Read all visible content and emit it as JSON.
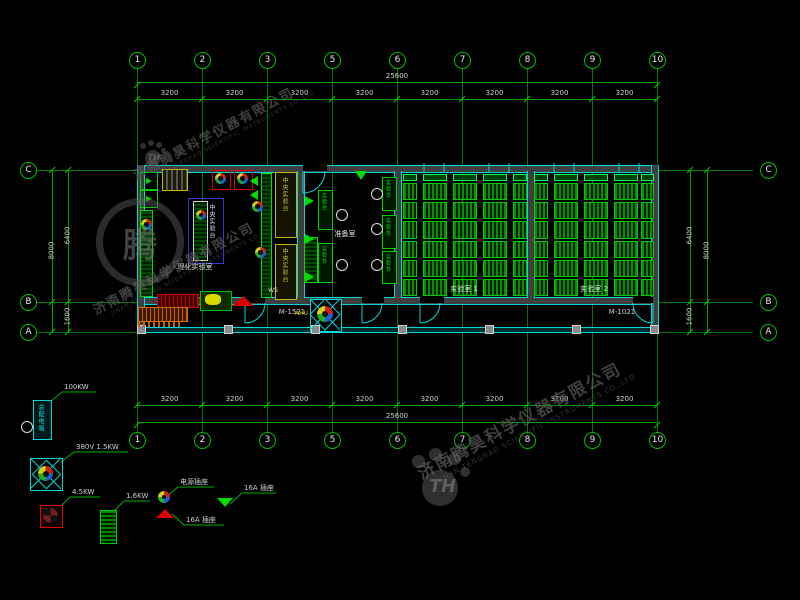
{
  "watermark": {
    "company_cn": "济南腾昊科学仪器有限公司",
    "company_en": "JINAN TENGHAO SCIENTIFIC INSTRUMENTS CO.,LTD",
    "logo_text": "TH",
    "logo_char": "腾"
  },
  "grid": {
    "column_labels": [
      "1",
      "2",
      "3",
      "5",
      "6",
      "7",
      "8",
      "9",
      "10"
    ],
    "row_labels": [
      "C",
      "B",
      "A"
    ],
    "bay_dims": [
      "3200",
      "3200",
      "3200",
      "3200",
      "3200",
      "3200",
      "3200",
      "3200"
    ],
    "total_dim": "25600",
    "left_dims": {
      "span_upper": "6400",
      "total": "8000",
      "span_lower": "1600"
    },
    "right_dims": {
      "span_upper": "6400",
      "total": "8000",
      "span_lower": "1600"
    }
  },
  "plan": {
    "door_left": "M-1521",
    "door_right": "M-1021",
    "room_left_label": "理化实验室",
    "room_middle_label": "准备室",
    "room1_label": "实验室 1",
    "room2_label": "实验室 2",
    "central_bench_label": "中央实验台",
    "side_bench_label": "实验台",
    "ahu_label": "AHU",
    "ws_label": "WS"
  },
  "legend": {
    "items": [
      {
        "id": "main-panel",
        "symbol": "distribution-box",
        "box_text": "总配电箱",
        "label": "100KW"
      },
      {
        "id": "fan-380v",
        "symbol": "axial-fan-cyan",
        "label": "380V 1.5KW"
      },
      {
        "id": "fan-45kw",
        "symbol": "axial-fan-red",
        "label": "4.5KW"
      },
      {
        "id": "heater",
        "symbol": "radiator-green",
        "label": "1.6KW"
      },
      {
        "id": "socket-power",
        "symbol": "socket-circle",
        "label": "电源插座"
      },
      {
        "id": "socket-16a-red",
        "symbol": "socket-triangle-red",
        "label": "16A 插座"
      },
      {
        "id": "socket-16a-green",
        "symbol": "socket-triangle-green",
        "label": "16A 插座"
      }
    ]
  },
  "colors": {
    "background": "#000000",
    "grid_line": "#008000",
    "dim_text": "#c8c8c8",
    "wall_cyan": "#00d8d8",
    "bench_green": "#00d400",
    "accent_blue": "#3838d8",
    "accent_yellow": "#c8b400",
    "accent_red": "#d80000",
    "accent_orange": "#c86400",
    "watermark_gray": "#3a3a3a"
  }
}
